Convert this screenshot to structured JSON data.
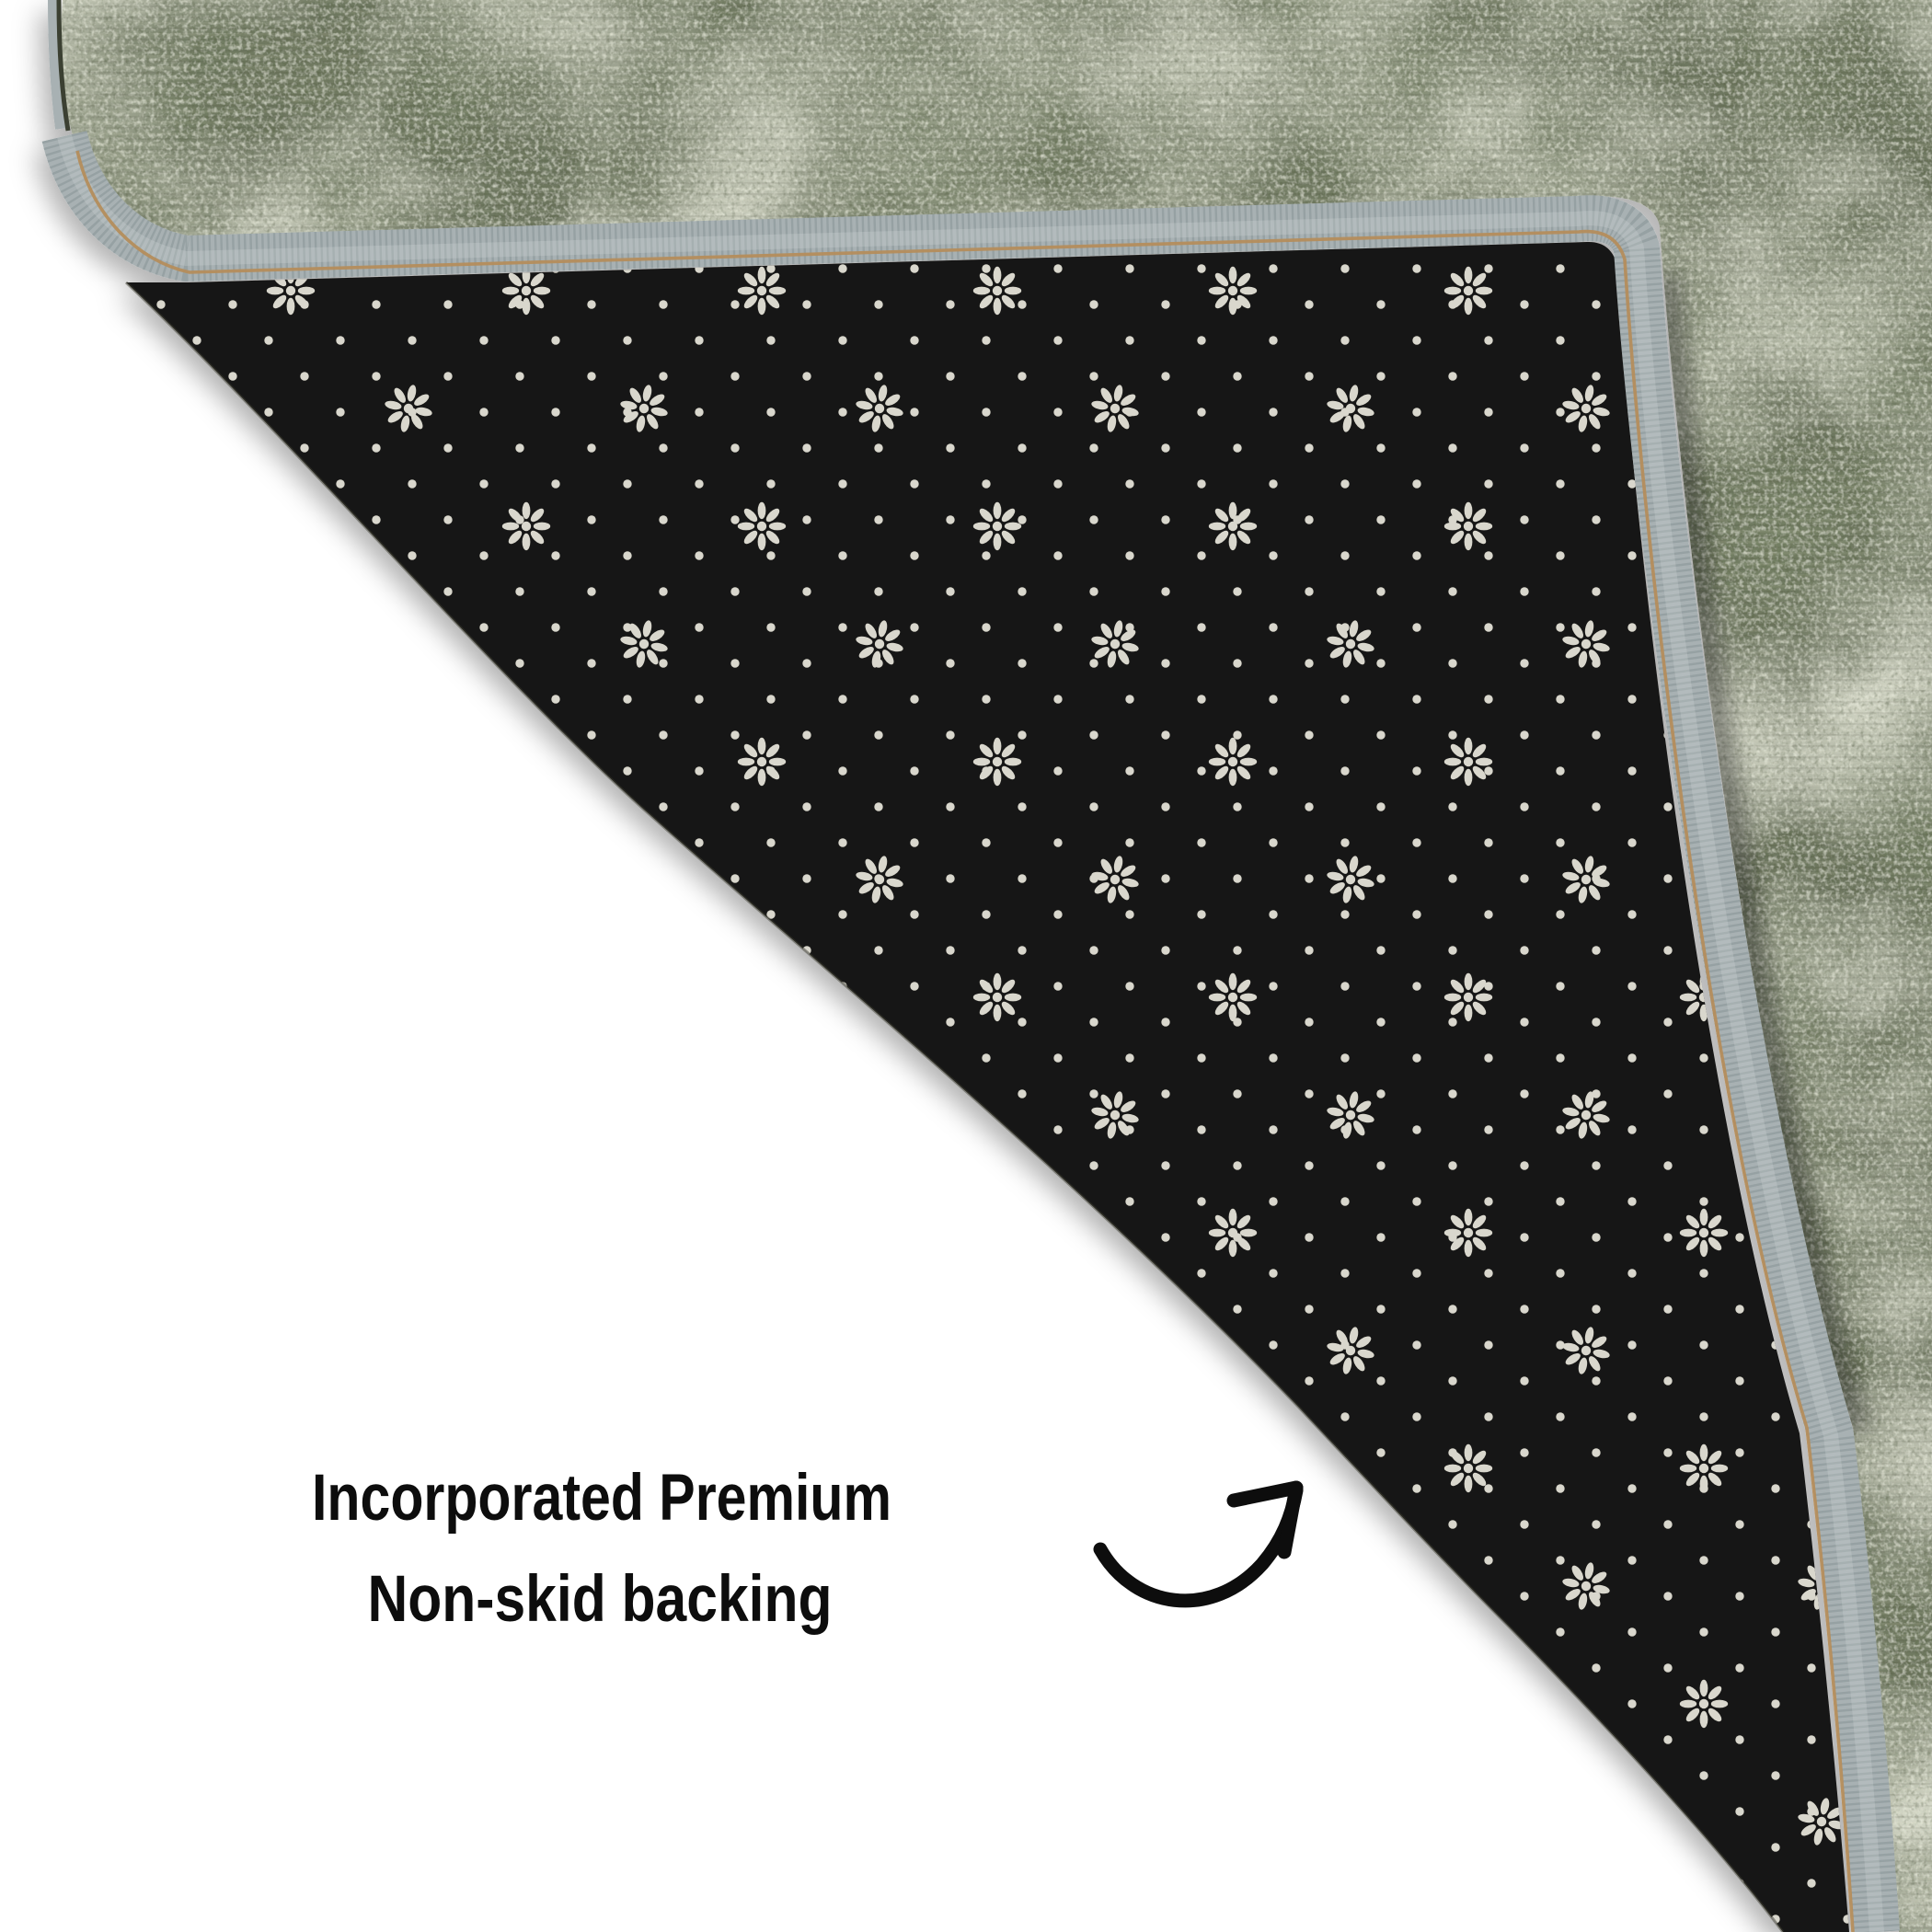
{
  "scene": {
    "type": "product-photo",
    "subject": "rug corner folded over to show non-skid backing",
    "background_color": "#ffffff"
  },
  "annotation": {
    "line1": "Incorporated Premium",
    "line2": "Non-skid backing",
    "text_color": "#0d0d0d",
    "arrow": "curved-up-right-arrow",
    "arrow_color": "#0d0d0d"
  },
  "rug": {
    "face_base_color": "#6d765f",
    "face_light_color": "#c7ccad",
    "face_dark_color": "#333a29",
    "binding_color": "#a8b1b3",
    "binding_rib_color": "#7e8a8c",
    "binding_stitch_color": "#b48d5c",
    "backing_color": "#171714",
    "backing_dot_color": "#d9d7cd",
    "backing_pattern": "anti-slip dots with eight-petal flower clusters"
  }
}
